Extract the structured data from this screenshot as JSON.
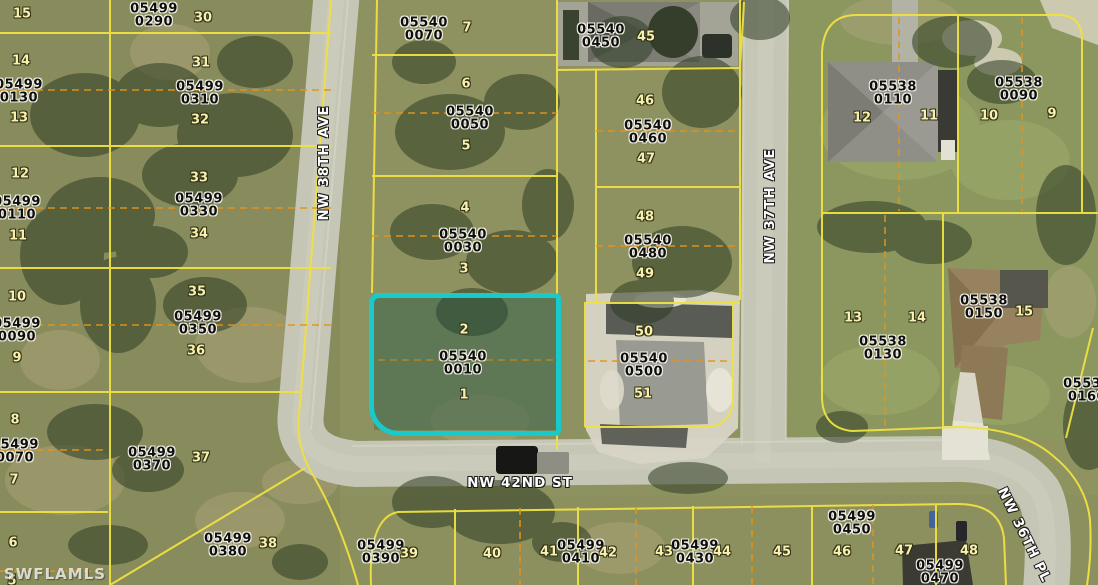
{
  "map": {
    "watermark": "SWFLAMLS",
    "highlighted_parcel": {
      "parcel_id": "05540 0010",
      "lot_numbers": [
        "2",
        "1"
      ],
      "highlight_color": "#19caca"
    },
    "colors": {
      "parcel_line": "#f0e142",
      "lot_split_line": "#e2941c",
      "road": "#c6c6b7",
      "highlight": "#19caca"
    },
    "street_labels": [
      {
        "text": "NW 38TH AVE",
        "x": 324,
        "y": 163,
        "rotate": -90
      },
      {
        "text": "NW 37TH AVE",
        "x": 770,
        "y": 206,
        "rotate": -90
      },
      {
        "text": "NW 42ND ST",
        "x": 520,
        "y": 483,
        "rotate": 0
      },
      {
        "text": "NW 36TH PL",
        "x": 1024,
        "y": 535,
        "rotate": 64
      }
    ],
    "parcel_labels": [
      {
        "line1": "05499",
        "line2": "0290",
        "x": 154,
        "y": 16
      },
      {
        "line1": "05499",
        "line2": "0130",
        "x": 19,
        "y": 92
      },
      {
        "line1": "05499",
        "line2": "0310",
        "x": 200,
        "y": 94
      },
      {
        "line1": "05499",
        "line2": "0110",
        "x": 17,
        "y": 209
      },
      {
        "line1": "05499",
        "line2": "0330",
        "x": 199,
        "y": 206
      },
      {
        "line1": "05499",
        "line2": "0090",
        "x": 17,
        "y": 331
      },
      {
        "line1": "05499",
        "line2": "0350",
        "x": 198,
        "y": 324
      },
      {
        "line1": "05499",
        "line2": "0070",
        "x": 15,
        "y": 452
      },
      {
        "line1": "05499",
        "line2": "0370",
        "x": 152,
        "y": 460
      },
      {
        "line1": "05499",
        "line2": "0380",
        "x": 228,
        "y": 546
      },
      {
        "line1": "05499",
        "line2": "0390",
        "x": 381,
        "y": 553
      },
      {
        "line1": "05499",
        "line2": "0410",
        "x": 581,
        "y": 553
      },
      {
        "line1": "05499",
        "line2": "0430",
        "x": 695,
        "y": 553
      },
      {
        "line1": "05499",
        "line2": "0450",
        "x": 852,
        "y": 524
      },
      {
        "line1": "05499",
        "line2": "0470",
        "x": 940,
        "y": 573
      },
      {
        "line1": "05540",
        "line2": "0070",
        "x": 424,
        "y": 30
      },
      {
        "line1": "05540",
        "line2": "0050",
        "x": 470,
        "y": 119
      },
      {
        "line1": "05540",
        "line2": "0030",
        "x": 463,
        "y": 242
      },
      {
        "line1": "05540",
        "line2": "0010",
        "x": 463,
        "y": 364
      },
      {
        "line1": "05540",
        "line2": "0450",
        "x": 601,
        "y": 37
      },
      {
        "line1": "05540",
        "line2": "0460",
        "x": 648,
        "y": 133
      },
      {
        "line1": "05540",
        "line2": "0480",
        "x": 648,
        "y": 248
      },
      {
        "line1": "05540",
        "line2": "0500",
        "x": 644,
        "y": 366
      },
      {
        "line1": "05538",
        "line2": "0110",
        "x": 893,
        "y": 94
      },
      {
        "line1": "05538",
        "line2": "0090",
        "x": 1019,
        "y": 90
      },
      {
        "line1": "05538",
        "line2": "0130",
        "x": 883,
        "y": 349
      },
      {
        "line1": "05538",
        "line2": "0150",
        "x": 984,
        "y": 308
      },
      {
        "line1": "05538",
        "line2": "0160",
        "x": 1087,
        "y": 391
      }
    ],
    "lot_numbers": [
      {
        "n": "15",
        "x": 22,
        "y": 14
      },
      {
        "n": "14",
        "x": 21,
        "y": 61
      },
      {
        "n": "13",
        "x": 19,
        "y": 118
      },
      {
        "n": "12",
        "x": 20,
        "y": 174
      },
      {
        "n": "11",
        "x": 18,
        "y": 236
      },
      {
        "n": "10",
        "x": 17,
        "y": 297
      },
      {
        "n": "9",
        "x": 17,
        "y": 358
      },
      {
        "n": "8",
        "x": 15,
        "y": 420
      },
      {
        "n": "7",
        "x": 14,
        "y": 480
      },
      {
        "n": "6",
        "x": 13,
        "y": 543
      },
      {
        "n": "5",
        "x": 12,
        "y": 581
      },
      {
        "n": "30",
        "x": 203,
        "y": 18
      },
      {
        "n": "31",
        "x": 201,
        "y": 63
      },
      {
        "n": "32",
        "x": 200,
        "y": 120
      },
      {
        "n": "33",
        "x": 199,
        "y": 178
      },
      {
        "n": "34",
        "x": 199,
        "y": 234
      },
      {
        "n": "35",
        "x": 197,
        "y": 292
      },
      {
        "n": "36",
        "x": 196,
        "y": 351
      },
      {
        "n": "37",
        "x": 201,
        "y": 458
      },
      {
        "n": "38",
        "x": 268,
        "y": 544
      },
      {
        "n": "7",
        "x": 467,
        "y": 28
      },
      {
        "n": "6",
        "x": 466,
        "y": 84
      },
      {
        "n": "5",
        "x": 466,
        "y": 146
      },
      {
        "n": "4",
        "x": 465,
        "y": 208
      },
      {
        "n": "3",
        "x": 464,
        "y": 269
      },
      {
        "n": "2",
        "x": 464,
        "y": 330
      },
      {
        "n": "1",
        "x": 464,
        "y": 395
      },
      {
        "n": "45",
        "x": 646,
        "y": 37
      },
      {
        "n": "46",
        "x": 645,
        "y": 101
      },
      {
        "n": "47",
        "x": 646,
        "y": 159
      },
      {
        "n": "48",
        "x": 645,
        "y": 217
      },
      {
        "n": "49",
        "x": 645,
        "y": 274
      },
      {
        "n": "50",
        "x": 644,
        "y": 332
      },
      {
        "n": "51",
        "x": 643,
        "y": 394
      },
      {
        "n": "12",
        "x": 862,
        "y": 118
      },
      {
        "n": "11",
        "x": 929,
        "y": 116
      },
      {
        "n": "10",
        "x": 989,
        "y": 116
      },
      {
        "n": "9",
        "x": 1052,
        "y": 114
      },
      {
        "n": "13",
        "x": 853,
        "y": 318
      },
      {
        "n": "14",
        "x": 917,
        "y": 318
      },
      {
        "n": "15",
        "x": 1024,
        "y": 312
      },
      {
        "n": "39",
        "x": 409,
        "y": 554
      },
      {
        "n": "40",
        "x": 492,
        "y": 554
      },
      {
        "n": "41",
        "x": 549,
        "y": 552
      },
      {
        "n": "42",
        "x": 608,
        "y": 553
      },
      {
        "n": "43",
        "x": 664,
        "y": 552
      },
      {
        "n": "44",
        "x": 722,
        "y": 552
      },
      {
        "n": "45",
        "x": 782,
        "y": 552
      },
      {
        "n": "46",
        "x": 842,
        "y": 552
      },
      {
        "n": "47",
        "x": 904,
        "y": 551
      },
      {
        "n": "48",
        "x": 969,
        "y": 551
      }
    ]
  }
}
